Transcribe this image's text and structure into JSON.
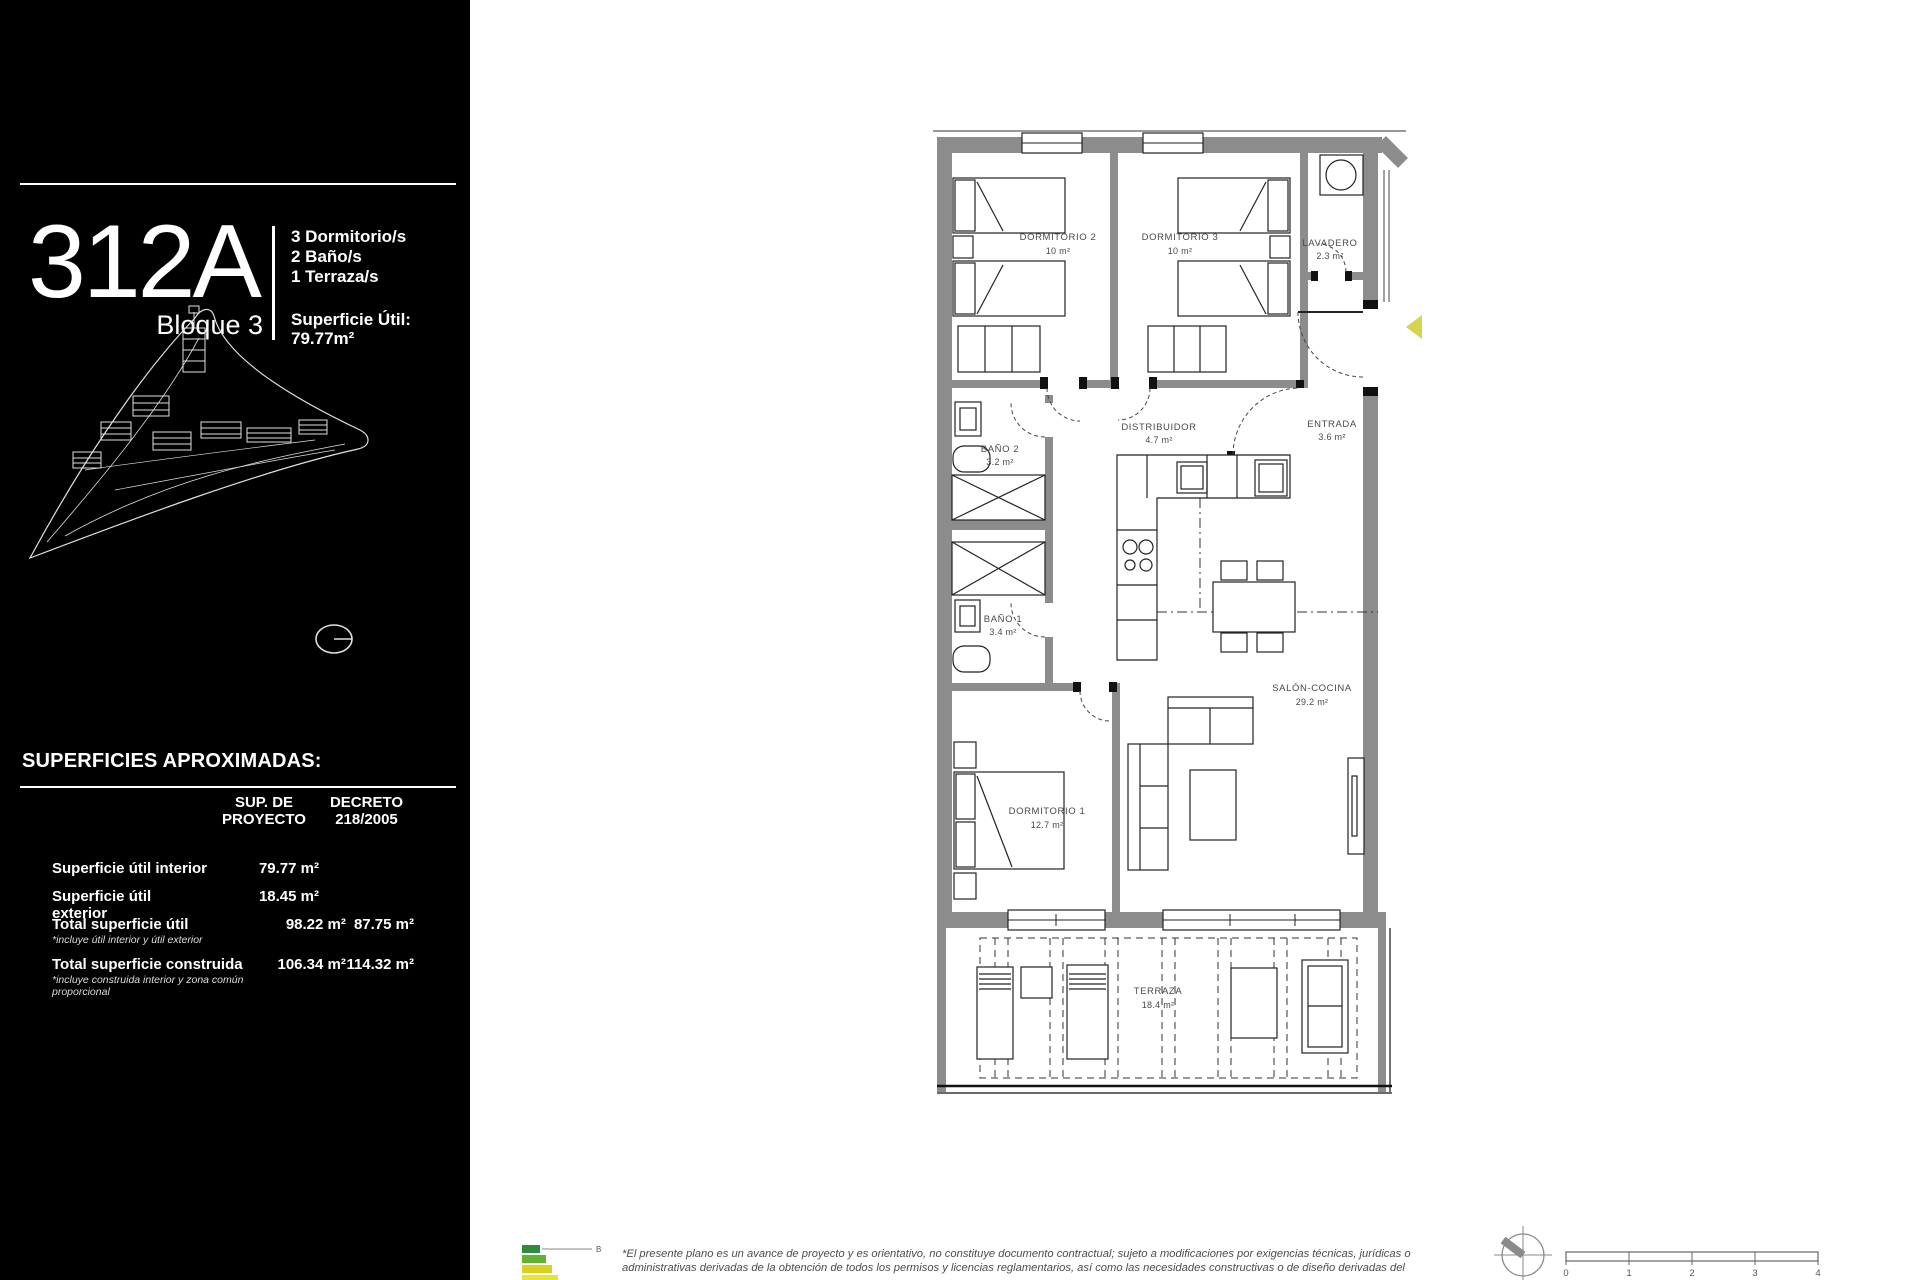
{
  "sidebar": {
    "unit_number": "312A",
    "block_label": "Bloque 3",
    "features": [
      "3 Dormitorio/s",
      "2 Baño/s",
      "1 Terraza/s"
    ],
    "surface_label": "Superficie Útil:",
    "surface_value": "79.77m²",
    "surfaces_title": "SUPERFICIES APROXIMADAS:",
    "table": {
      "col_project_line1": "SUP. DE",
      "col_project_line2": "PROYECTO",
      "col_decree_line1": "DECRETO",
      "col_decree_line2": "218/2005",
      "rows": [
        {
          "label": "Superficie útil interior",
          "note": "",
          "proyecto": "79.77 m²",
          "decreto": ""
        },
        {
          "label": "Superficie útil exterior",
          "note": "",
          "proyecto": "18.45 m²",
          "decreto": ""
        },
        {
          "label": "Total superficie útil",
          "note": "*incluye útil interior y útil exterior",
          "proyecto": "98.22 m²",
          "decreto": "87.75 m²"
        },
        {
          "label": "Total superficie construida",
          "note": "*incluye construida interior y zona común proporcional",
          "proyecto": "106.34 m²",
          "decreto": "114.32 m²"
        }
      ]
    }
  },
  "plan": {
    "rooms": [
      {
        "name": "DORMITORIO 2",
        "area": "10 m²"
      },
      {
        "name": "DORMITORIO 3",
        "area": "10 m²"
      },
      {
        "name": "LAVADERO",
        "area": "2.3 m²"
      },
      {
        "name": "ENTRADA",
        "area": "3.6 m²"
      },
      {
        "name": "DISTRIBUIDOR",
        "area": "4.7 m²"
      },
      {
        "name": "BAÑO 2",
        "area": "3.2 m²"
      },
      {
        "name": "BAÑO 1",
        "area": "3.4 m²"
      },
      {
        "name": "DORMITORIO 1",
        "area": "12.7 m²"
      },
      {
        "name": "SALÓN-COCINA",
        "area": "29.2 m²"
      },
      {
        "name": "TERRAZA",
        "area": "18.4 m²"
      }
    ],
    "entrance_marker_color": "#d4d44e"
  },
  "footer": {
    "energy_rating": "B",
    "disclaimer_line1": "*El presente plano es un avance de proyecto y es orientativo, no constituye documento contractual; sujeto a modificaciones por exigencias técnicas, jurídicas o",
    "disclaimer_line2": "administrativas derivadas de la obtención de todos los permisos y licencias reglamentarios, así como las necesidades constructivas o de diseño derivadas del",
    "scale_ticks": [
      "0",
      "1",
      "2",
      "3",
      "4"
    ]
  },
  "colors": {
    "sidebar_bg": "#000000",
    "wall_gray": "#8c8c8c",
    "accent_yellow": "#d4d44e"
  }
}
